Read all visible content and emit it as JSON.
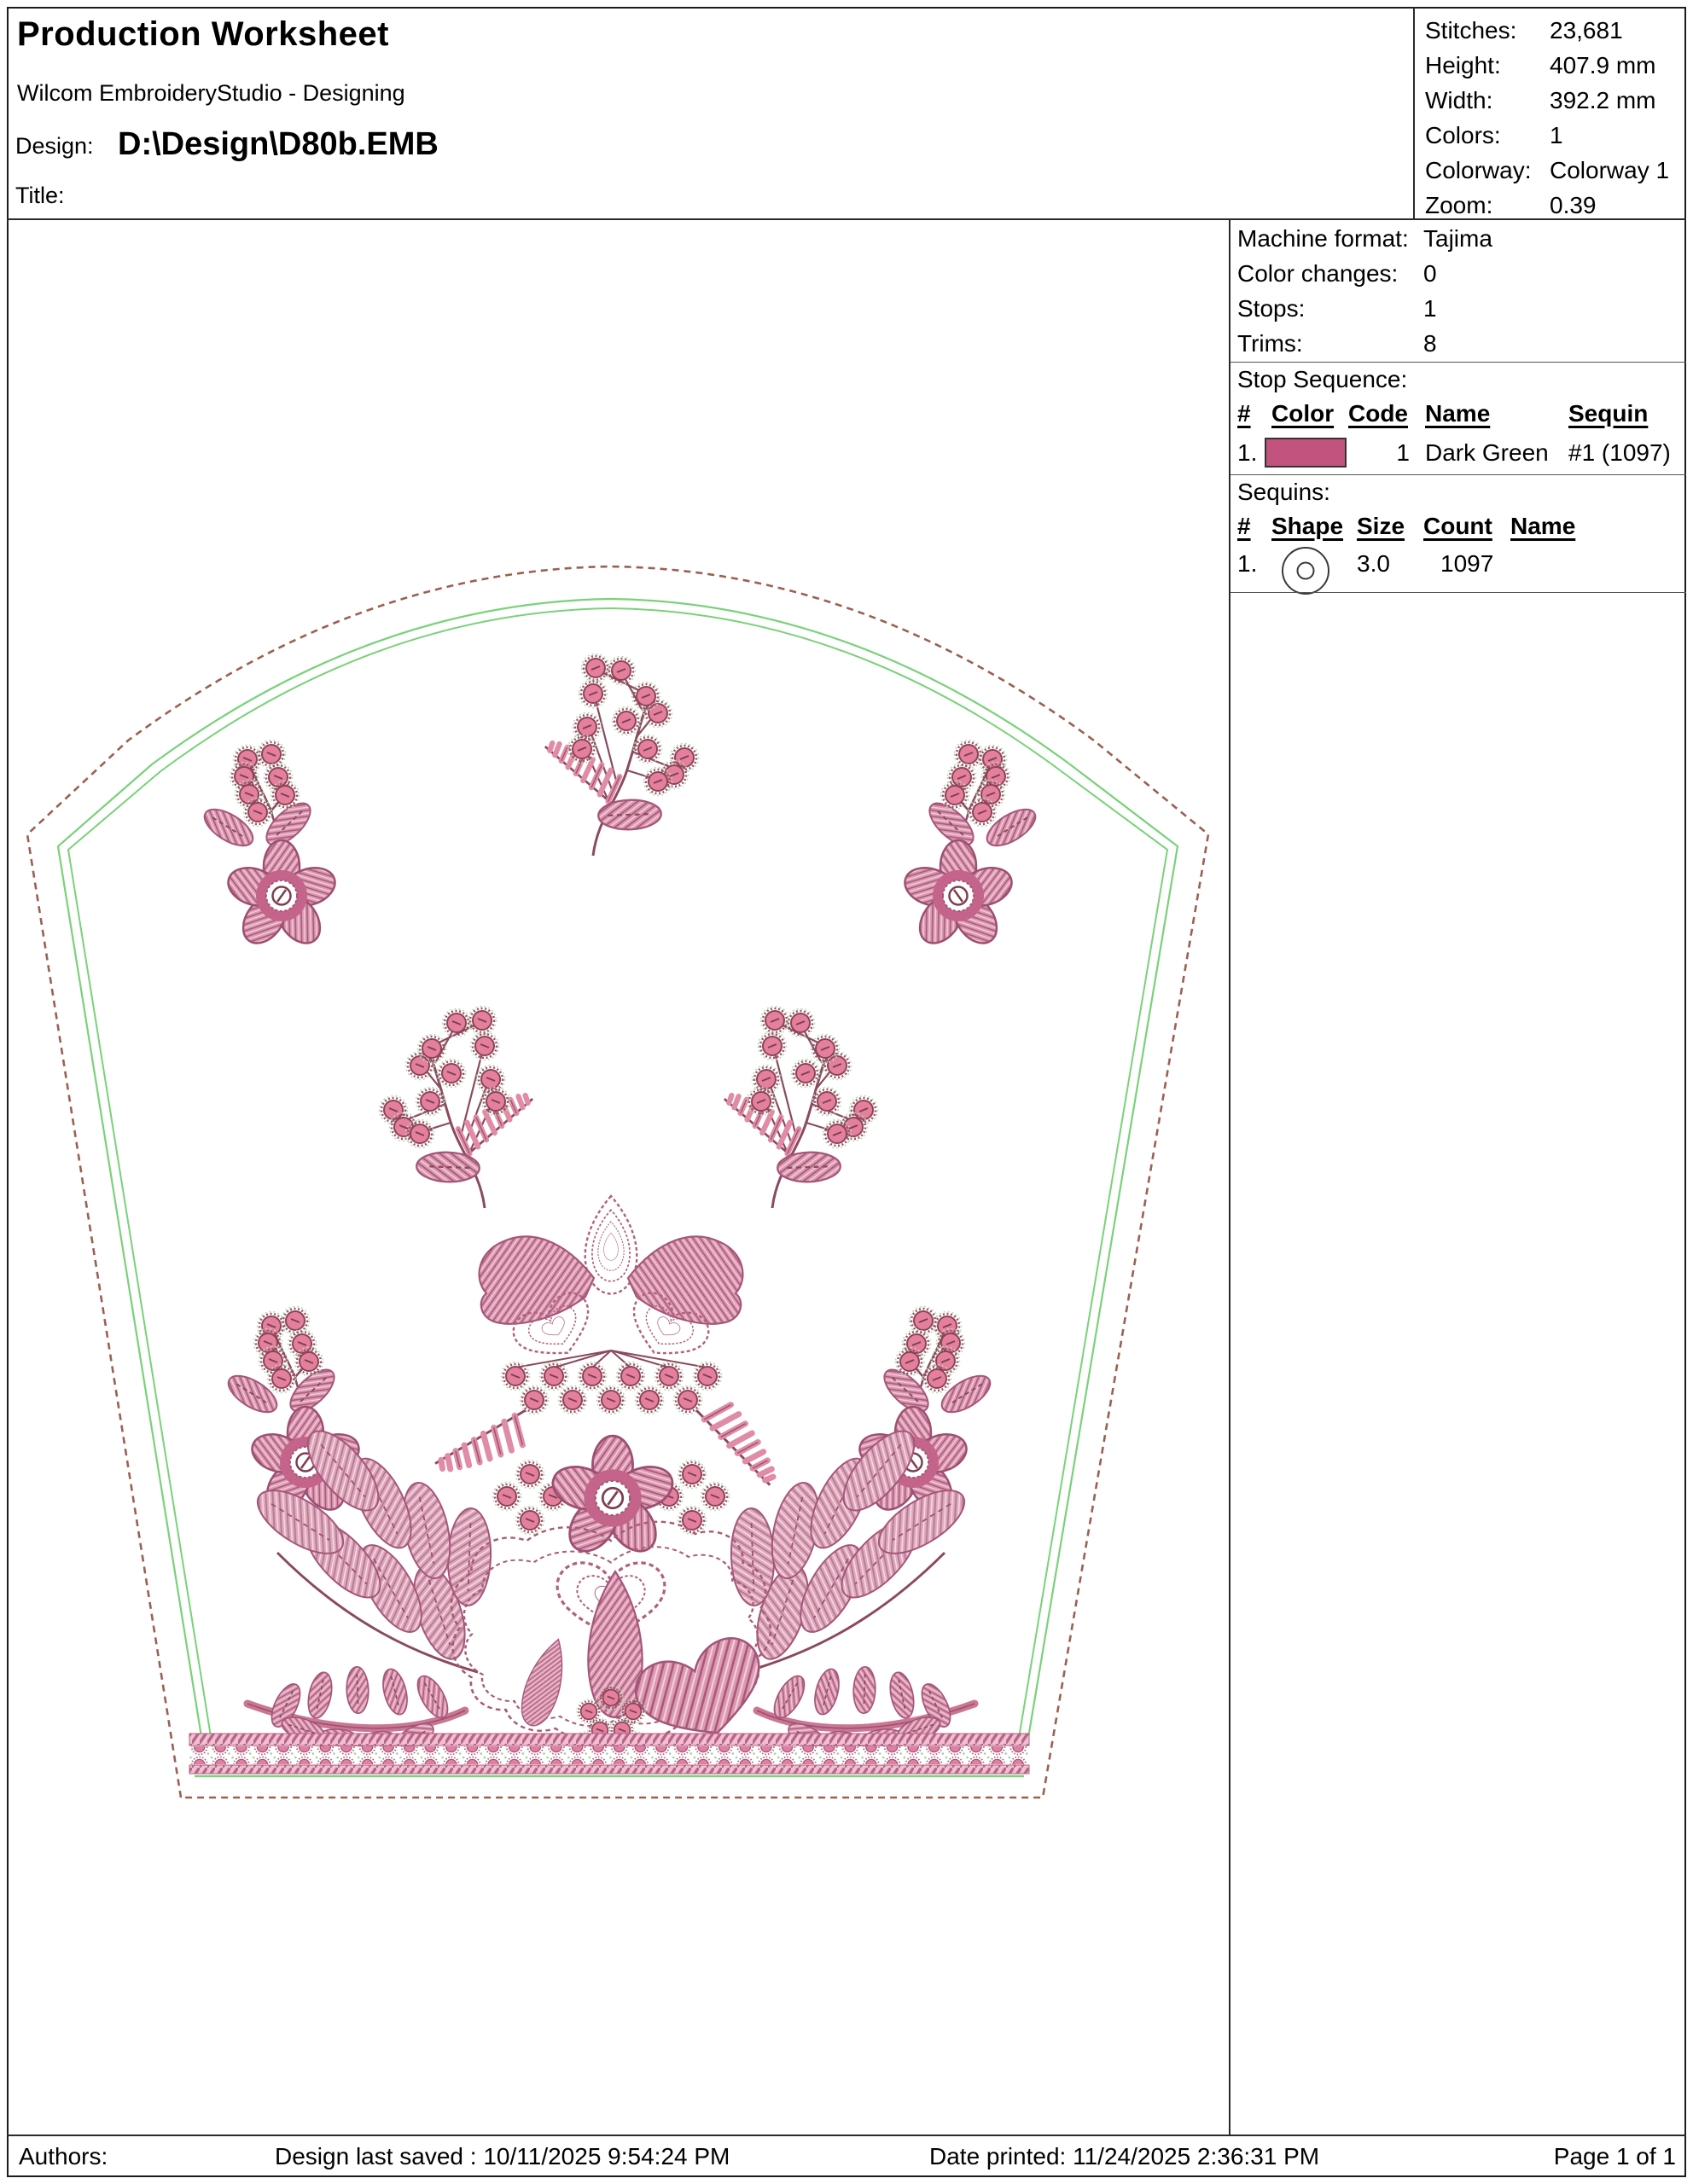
{
  "header": {
    "title": "Production Worksheet",
    "subtitle": "Wilcom EmbroideryStudio - Designing",
    "design_label": "Design:",
    "design_path": "D:\\Design\\D80b.EMB",
    "title_label": "Title:"
  },
  "info_box": {
    "rows": [
      {
        "label": "Stitches:",
        "value": "23,681"
      },
      {
        "label": "Height:",
        "value": "407.9 mm"
      },
      {
        "label": "Width:",
        "value": "392.2 mm"
      },
      {
        "label": "Colors:",
        "value": "1"
      },
      {
        "label": "Colorway:",
        "value": "Colorway 1"
      },
      {
        "label": "Zoom:",
        "value": "0.39"
      }
    ]
  },
  "machine_info": {
    "rows": [
      {
        "label": "Machine format:",
        "value": "Tajima"
      },
      {
        "label": "Color changes:",
        "value": "0"
      },
      {
        "label": "Stops:",
        "value": "1"
      },
      {
        "label": "Trims:",
        "value": "8"
      }
    ]
  },
  "stop_sequence": {
    "heading": "Stop Sequence:",
    "columns": [
      "#",
      "Color",
      "Code",
      "Name",
      "Sequin"
    ],
    "rows": [
      {
        "num": "1.",
        "color": "#c2527e",
        "code": "1",
        "name": "Dark Green",
        "sequin": "#1 (1097)"
      }
    ]
  },
  "sequins": {
    "heading": "Sequins:",
    "columns": [
      "#",
      "Shape",
      "Size",
      "Count",
      "Name"
    ],
    "rows": [
      {
        "num": "1.",
        "shape": "circle-sequin",
        "size": "3.0",
        "count": "1097",
        "name": ""
      }
    ]
  },
  "footer": {
    "authors_label": "Authors:",
    "last_saved": "Design last saved : 10/11/2025 9:54:24 PM",
    "date_printed": "Date printed: 11/24/2025 2:36:31 PM",
    "page": "Page 1 of 1"
  },
  "design_preview": {
    "description": "Arched floral embroidery design preview with pink flowers, berry sprigs, fern leaves and decorative bottom band",
    "colors": {
      "thread_pink": "#e4809e",
      "thread_mid_pink": "#cb7793",
      "thread_dark": "#9c5070",
      "stitch_outline": "#8a4a5f",
      "guide_green": "#7ad17a",
      "boundary_dashed_brown": "#9b6050",
      "swatch_rose": "#c2527e"
    }
  }
}
